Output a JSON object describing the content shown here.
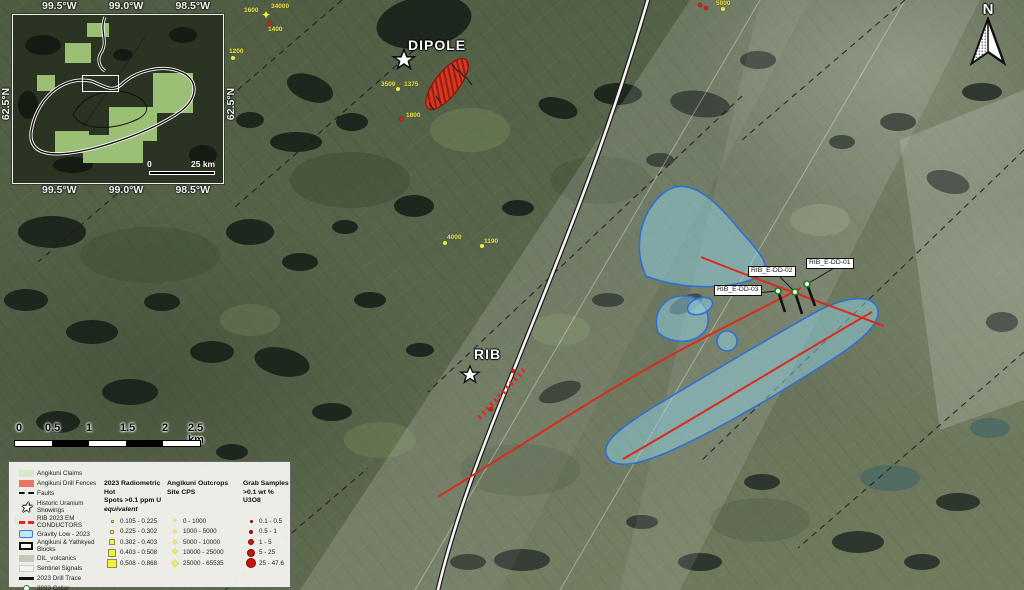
{
  "map": {
    "targets": {
      "dipole": "DIPOLE",
      "rib": "RIB"
    },
    "north_label": "N",
    "drillholes": [
      {
        "label": "RIB_E-DD-01",
        "bx": 806,
        "by": 258,
        "cx": 807,
        "cy": 284,
        "tx": 815,
        "ty": 306
      },
      {
        "label": "RIB_E-DD-02",
        "bx": 748,
        "by": 266,
        "cx": 795,
        "cy": 292,
        "tx": 802,
        "ty": 314
      },
      {
        "label": "RIB_E-DD-03",
        "bx": 714,
        "by": 285,
        "cx": 778,
        "cy": 291,
        "tx": 785,
        "ty": 312
      }
    ],
    "spots": [
      {
        "t": "1600",
        "x": 244,
        "y": 7
      },
      {
        "t": "34000",
        "x": 271,
        "y": 3
      },
      {
        "t": "1400",
        "x": 268,
        "y": 26
      },
      {
        "t": "1200",
        "x": 229,
        "y": 48
      },
      {
        "t": "5000",
        "x": 716,
        "y": 0
      },
      {
        "t": "3500",
        "x": 381,
        "y": 81
      },
      {
        "t": "1375",
        "x": 404,
        "y": 81
      },
      {
        "t": "1800",
        "x": 406,
        "y": 112
      },
      {
        "t": "4000",
        "x": 447,
        "y": 234
      },
      {
        "t": "1190",
        "x": 484,
        "y": 238
      }
    ],
    "markers": [
      {
        "k": "ystar",
        "x": 261,
        "y": 10
      },
      {
        "k": "rdot",
        "x": 268,
        "y": 21
      },
      {
        "k": "ydot",
        "x": 231,
        "y": 56
      },
      {
        "k": "ydot",
        "x": 396,
        "y": 87
      },
      {
        "k": "rdot",
        "x": 399,
        "y": 117
      },
      {
        "k": "ydot",
        "x": 443,
        "y": 241
      },
      {
        "k": "ydot",
        "x": 480,
        "y": 244
      },
      {
        "k": "ydot",
        "x": 721,
        "y": 7
      },
      {
        "k": "rdot",
        "x": 698,
        "y": 3
      },
      {
        "k": "rdot",
        "x": 704,
        "y": 6
      },
      {
        "k": "rdot",
        "x": 511,
        "y": 369
      },
      {
        "k": "rdot",
        "x": 489,
        "y": 407
      }
    ]
  },
  "inset": {
    "lon_labels": [
      "99.5°W",
      "99.0°W",
      "98.5°W"
    ],
    "lat_label": "62.5°N",
    "scale_zero": "0",
    "scale_text": "25 km"
  },
  "scalebar": {
    "ticks": [
      "0",
      "0.5",
      "1",
      "1.5",
      "2",
      "2.5 km"
    ]
  },
  "legend": {
    "items": [
      {
        "sym": "sym-claims",
        "label": "Angikuni Claims"
      },
      {
        "sym": "sym-fence",
        "label": "Angikuni Drill Fences"
      },
      {
        "sym": "sym-fault",
        "label": "Faults"
      },
      {
        "sym": "sym-star",
        "label": "Historic Uranium Showings"
      },
      {
        "sym": "sym-conductor",
        "label": "RIB 2023 EM CONDUCTORS"
      },
      {
        "sym": "sym-gravity",
        "label": "Gravity Low - 2023"
      },
      {
        "sym": "sym-blocks",
        "label": "Angikuni & Yathkyed Blocks"
      },
      {
        "sym": "sym-volcanics",
        "label": "DIL_volcanics"
      },
      {
        "sym": "sym-sentinel",
        "label": "Sentinel Signals"
      },
      {
        "sym": "sym-trace",
        "label": "2023 Drill Trace"
      },
      {
        "sym": "sym-collar",
        "label": "2023 Collar"
      }
    ],
    "rad": {
      "h1": "2023 Radiometric Hot",
      "h2": "Spots >0.1 ppm U",
      "h3": "equivalent",
      "rows": [
        "0.105 - 0.225",
        "0.225 - 0.302",
        "0.302 - 0.403",
        "0.403 - 0.508",
        "0.508 - 0.868"
      ]
    },
    "out": {
      "h1": "Angikuni Outcrops",
      "h2": "Site CPS",
      "rows": [
        "0 - 1000",
        "1000 - 5000",
        "5000 - 10000",
        "10000 - 25000",
        "25000 - 65535"
      ]
    },
    "grab": {
      "h1": "Grab Samples",
      "h2": ">0.1 wt % U3O8",
      "rows": [
        "0.1 - 0.5",
        "0.5 - 1",
        "1 - 5",
        "5 - 25",
        "25 - 47.6"
      ]
    }
  },
  "colors": {
    "conductor_red": "#d92b1f",
    "gravity_fill": "#8fd4e6",
    "gravity_stroke": "#2f6fd6",
    "spot_yellow": "#efec3e",
    "hotspot_red": "#d63723"
  }
}
